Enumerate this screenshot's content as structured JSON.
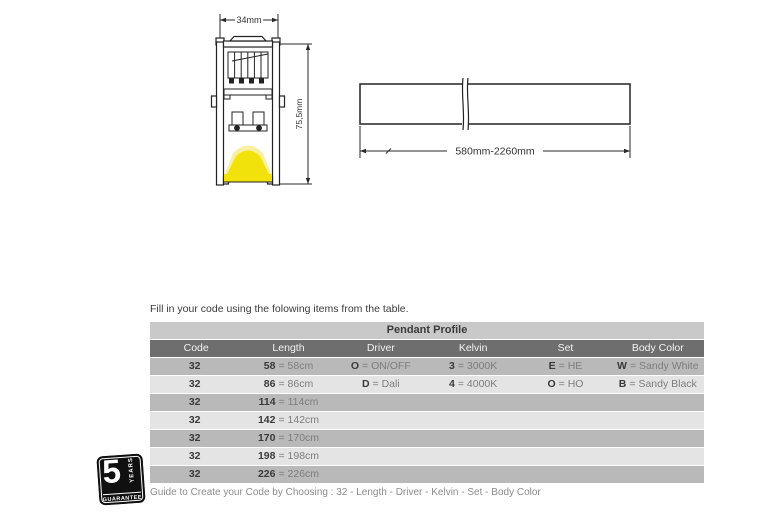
{
  "diagram": {
    "cross_section": {
      "width_label": "34mm",
      "height_label": "75,5mm"
    },
    "side_view": {
      "length_label": "580mm-2260mm"
    }
  },
  "intro_text": "Fill in your code using the folowing items from the table.",
  "table": {
    "title": "Pendant Profile",
    "headers": [
      "Code",
      "Length",
      "Driver",
      "Kelvin",
      "Set",
      "Body Color"
    ],
    "rows": [
      {
        "cells": [
          {
            "b": "32",
            "v": ""
          },
          {
            "b": "58",
            "v": "= 58cm"
          },
          {
            "b": "O",
            "v": "= ON/OFF"
          },
          {
            "b": "3",
            "v": "= 3000K"
          },
          {
            "b": "E",
            "v": "= HE"
          },
          {
            "b": "W",
            "v": "= Sandy White"
          }
        ]
      },
      {
        "cells": [
          {
            "b": "32",
            "v": ""
          },
          {
            "b": "86",
            "v": "= 86cm"
          },
          {
            "b": "D",
            "v": "= Dali"
          },
          {
            "b": "4",
            "v": "= 4000K"
          },
          {
            "b": "O",
            "v": "= HO"
          },
          {
            "b": "B",
            "v": "= Sandy Black"
          }
        ]
      },
      {
        "cells": [
          {
            "b": "32",
            "v": ""
          },
          {
            "b": "114",
            "v": "= 114cm"
          },
          {
            "b": "",
            "v": ""
          },
          {
            "b": "",
            "v": ""
          },
          {
            "b": "",
            "v": ""
          },
          {
            "b": "",
            "v": ""
          }
        ]
      },
      {
        "cells": [
          {
            "b": "32",
            "v": ""
          },
          {
            "b": "142",
            "v": "= 142cm"
          },
          {
            "b": "",
            "v": ""
          },
          {
            "b": "",
            "v": ""
          },
          {
            "b": "",
            "v": ""
          },
          {
            "b": "",
            "v": ""
          }
        ]
      },
      {
        "cells": [
          {
            "b": "32",
            "v": ""
          },
          {
            "b": "170",
            "v": "= 170cm"
          },
          {
            "b": "",
            "v": ""
          },
          {
            "b": "",
            "v": ""
          },
          {
            "b": "",
            "v": ""
          },
          {
            "b": "",
            "v": ""
          }
        ]
      },
      {
        "cells": [
          {
            "b": "32",
            "v": ""
          },
          {
            "b": "198",
            "v": "= 198cm"
          },
          {
            "b": "",
            "v": ""
          },
          {
            "b": "",
            "v": ""
          },
          {
            "b": "",
            "v": ""
          },
          {
            "b": "",
            "v": ""
          }
        ]
      },
      {
        "cells": [
          {
            "b": "32",
            "v": ""
          },
          {
            "b": "226",
            "v": "= 226cm"
          },
          {
            "b": "",
            "v": ""
          },
          {
            "b": "",
            "v": ""
          },
          {
            "b": "",
            "v": ""
          },
          {
            "b": "",
            "v": ""
          }
        ]
      }
    ]
  },
  "guide_text": "Guide to Create your Code by Choosing : 32 - Length - Driver - Kelvin - Set - Body Color",
  "badge": {
    "number": "5",
    "years": "YEARS ✱",
    "guarantee": "GUARANTEE"
  },
  "colors": {
    "led_yellow": "#f2e20b",
    "led_yellow_soft": "#f8f0a0",
    "table_title_bg": "#c9c9c9",
    "table_header_bg": "#6e6e6e",
    "row_dark": "#b9b9b9",
    "row_light": "#e4e4e4",
    "line_color": "#2a2a2a"
  }
}
